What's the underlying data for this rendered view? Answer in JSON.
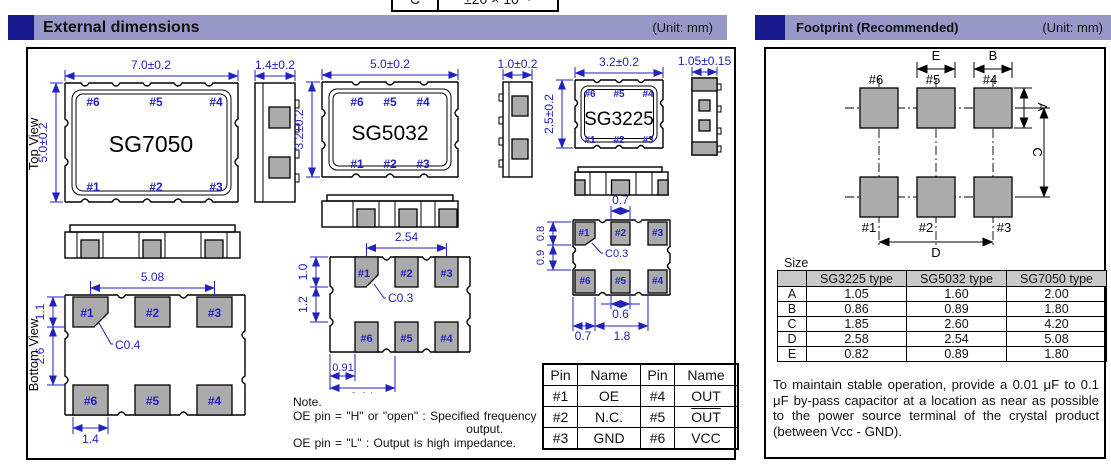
{
  "clipped_table": {
    "col1": "C",
    "col2": "±20 × 10⁻⁶"
  },
  "headers": {
    "external": {
      "title": "External dimensions",
      "unit": "(Unit: mm)"
    },
    "footprint": {
      "title": "Footprint (Recommended)",
      "unit": "(Unit: mm)"
    }
  },
  "view_labels": {
    "top": "Top View",
    "bottom": "Bottom View"
  },
  "colors": {
    "accent_navy": "#1a1a8f",
    "header_bar": "#9898c8",
    "dimension_blue": "#2222bd",
    "pad_gray": "#ababab",
    "table_header_gray": "#c9c9c9"
  },
  "sg7050": {
    "name": "SG7050",
    "top_pins": [
      "#6",
      "#5",
      "#4"
    ],
    "bottom_pins": [
      "#1",
      "#2",
      "#3"
    ],
    "pad_labels_row1": [
      "#1",
      "#2",
      "#3"
    ],
    "pad_labels_row2": [
      "#6",
      "#5",
      "#4"
    ],
    "dims": {
      "body_width": "7.0±0.2",
      "body_height": "5.0±0.2",
      "thickness": "1.4±0.2",
      "pad_pitch": "5.08",
      "pad_height": "1.1",
      "pad_gap": "2.6",
      "chamfer": "C0.4",
      "pad_width": "1.4"
    }
  },
  "sg5032": {
    "name": "SG5032",
    "top_pins": [
      "#6",
      "#5",
      "#4"
    ],
    "bottom_pins": [
      "#1",
      "#2",
      "#3"
    ],
    "pad_labels_row1": [
      "#1",
      "#2",
      "#3"
    ],
    "pad_labels_row2": [
      "#6",
      "#5",
      "#4"
    ],
    "dims": {
      "body_width": "5.0±0.2",
      "body_height": "3.2±0.2",
      "thickness": "1.0±0.2",
      "pad_pitch": "2.54",
      "pad_height": "1.0",
      "pad_gap": "1.2",
      "chamfer": "C0.3",
      "edge_offset": "0.91",
      "clipped_dim": "2.64"
    }
  },
  "sg3225": {
    "name": "SG3225",
    "top_pins": [
      "#6",
      "#5",
      "#4"
    ],
    "bottom_pins": [
      "#1",
      "#2",
      "#3"
    ],
    "pad_labels_row1": [
      "#1",
      "#2",
      "#3"
    ],
    "pad_labels_row2": [
      "#6",
      "#5",
      "#4"
    ],
    "dims": {
      "body_width": "3.2±0.2",
      "body_height": "2.5±0.2",
      "thickness": "1.05±0.15",
      "pad2_width": "0.7",
      "pad_height": "0.8",
      "pad_gap": "0.9",
      "chamfer": "C0.3",
      "pad5_width": "0.6",
      "edge_offset": "0.7",
      "pad_span": "1.8"
    }
  },
  "pin_table": {
    "headers": [
      "Pin",
      "Name",
      "Pin",
      "Name"
    ],
    "rows": [
      {
        "pin_a": "#1",
        "name_a": "OE",
        "pin_b": "#4",
        "name_b": "OUT",
        "name_b_overline": false
      },
      {
        "pin_a": "#2",
        "name_a": "N.C.",
        "pin_b": "#5",
        "name_b": "OUT",
        "name_b_overline": true
      },
      {
        "pin_a": "#3",
        "name_a": "GND",
        "pin_b": "#6",
        "name_b": "VCC",
        "name_b_overline": false
      }
    ]
  },
  "note": {
    "title": "Note.",
    "line1": "OE pin = \"H\" or \"open\" : Specified frequency",
    "line2": "output.",
    "line3": "OE pin = \"L\" : Output is high impedance."
  },
  "footprint": {
    "pad_labels_row1": [
      "#6",
      "#5",
      "#4"
    ],
    "pad_labels_row2": [
      "#1",
      "#2",
      "#3"
    ],
    "dim_letters": {
      "a": "A",
      "b": "B",
      "c": "C",
      "d": "D",
      "e": "E"
    },
    "size_label": "Size",
    "size_table": {
      "col_headers": [
        "SG3225 type",
        "SG5032 type",
        "SG7050 type"
      ],
      "rows": [
        {
          "label": "A",
          "sg3225": "1.05",
          "sg5032": "1.60",
          "sg7050": "2.00"
        },
        {
          "label": "B",
          "sg3225": "0.86",
          "sg5032": "0.89",
          "sg7050": "1.80"
        },
        {
          "label": "C",
          "sg3225": "1.85",
          "sg5032": "2.60",
          "sg7050": "4.20"
        },
        {
          "label": "D",
          "sg3225": "2.58",
          "sg5032": "2.54",
          "sg7050": "5.08"
        },
        {
          "label": "E",
          "sg3225": "0.82",
          "sg5032": "0.89",
          "sg7050": "1.80"
        }
      ]
    },
    "note": "To maintain stable operation, provide a 0.01 μF to 0.1 μF by-pass capacitor at a location as near as possible to the power source terminal of the crystal product (between Vcc - GND)."
  }
}
